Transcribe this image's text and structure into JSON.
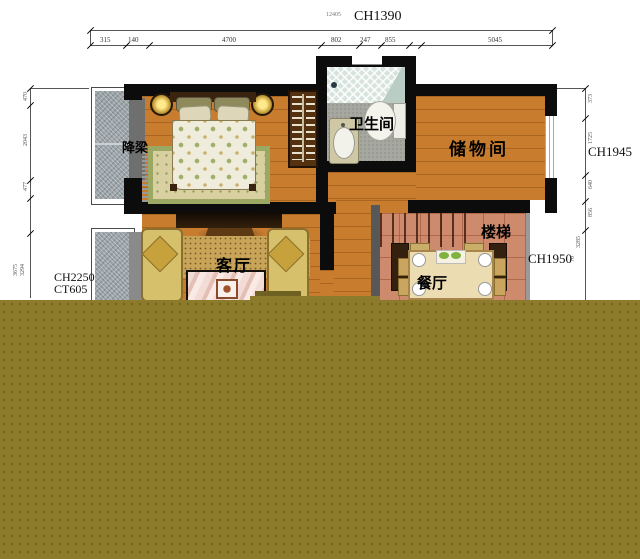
{
  "colors": {
    "overlay_olive": "#8d7b2c",
    "overlay_olive_dot": "#72641f",
    "wood_floor": "#c87c2e",
    "stairs_tile": "#cd8a6d",
    "wall_black": "#0c0c0c",
    "window_gray": "#9ba4a8"
  },
  "top_dim": {
    "label": "CH1390",
    "total": "12405",
    "segments": [
      "315",
      "140",
      "4700",
      "802",
      "247",
      "855",
      "5045"
    ]
  },
  "left_dim": {
    "ch": "CH2250",
    "ct": "CT605",
    "ticks": [
      "470",
      "2043",
      "477",
      "3675",
      "3294"
    ]
  },
  "right_dim": {
    "upper": "CH1945",
    "lower": "CH1950",
    "ticks": [
      "373",
      "1725",
      "640",
      "856",
      "3285",
      "70"
    ]
  },
  "rooms": {
    "beam": "降梁",
    "bathroom": "卫生间",
    "storage": "储物间",
    "living": "客厅",
    "stairs": "楼梯",
    "dining": "餐厅"
  }
}
